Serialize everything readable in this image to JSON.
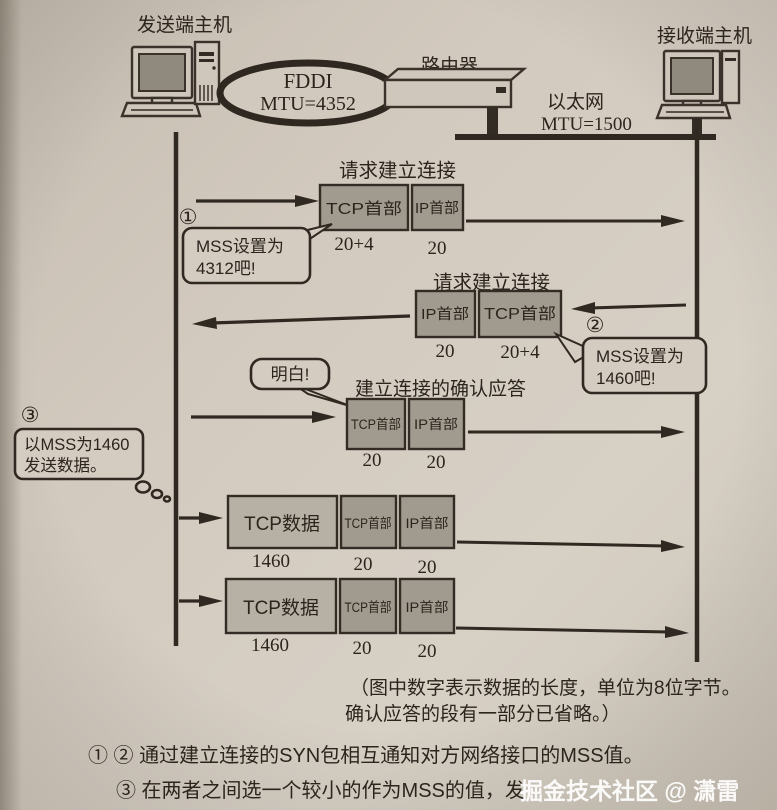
{
  "topology": {
    "sender_host": "发送端主机",
    "receiver_host": "接收端主机",
    "fddi_name": "FDDI",
    "fddi_mtu": "MTU=4352",
    "router_label": "路由器",
    "ethernet_name": "以太网",
    "ethernet_mtu": "MTU=1500"
  },
  "flows": {
    "row1": {
      "step": "①",
      "title": "请求建立连接",
      "seg1": {
        "label": "TCP首部",
        "size": "20+4"
      },
      "seg2": {
        "label": "IP首部",
        "size": "20"
      },
      "bubble": {
        "line1": "MSS设置为",
        "line2": "4312吧!"
      }
    },
    "row2": {
      "step": "②",
      "title": "请求建立连接",
      "seg1": {
        "label": "IP首部",
        "size": "20"
      },
      "seg2": {
        "label": "TCP首部",
        "size": "20+4"
      },
      "bubble": {
        "line1": "MSS设置为",
        "line2": "1460吧!"
      }
    },
    "row3": {
      "title": "建立连接的确认应答",
      "bubble": "明白!",
      "seg1": {
        "label": "TCP首部",
        "size": "20"
      },
      "seg2": {
        "label": "IP首部",
        "size": "20"
      }
    },
    "note3": {
      "step": "③",
      "line1": "以MSS为1460",
      "line2": "发送数据。"
    },
    "row4": {
      "seg1": {
        "label": "TCP数据",
        "size": "1460"
      },
      "seg2": {
        "label": "TCP首部",
        "size": "20"
      },
      "seg3": {
        "label": "IP首部",
        "size": "20"
      }
    },
    "row5": {
      "seg1": {
        "label": "TCP数据",
        "size": "1460"
      },
      "seg2": {
        "label": "TCP首部",
        "size": "20"
      },
      "seg3": {
        "label": "IP首部",
        "size": "20"
      }
    }
  },
  "footer": {
    "caption_line1": "（图中数字表示数据的长度，单位为8位字节。",
    "caption_line2": "确认应答的段有一部分已省略。）",
    "note_12": "① ② 通过建立连接的SYN包相互通知对方网络接口的MSS值。",
    "note_3": "③ 在两者之间选一个较小的作为MSS的值，发",
    "watermark": "掘金技术社区 @ 潇雷"
  }
}
